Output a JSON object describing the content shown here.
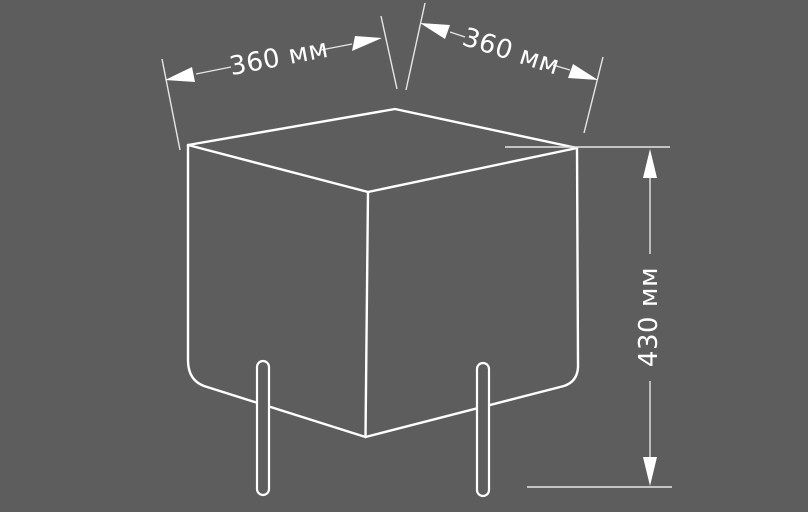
{
  "figure": {
    "type": "technical-dimension-diagram",
    "subject": "cube pouf on cylindrical legs, three-quarter view",
    "colors": {
      "background": "#5d5d5d",
      "outline": "#ffffff",
      "dim_line": "#e6e6e6",
      "arrow": "#ffffff",
      "text": "#ffffff"
    },
    "dimensions": {
      "width": {
        "label": "360 мм"
      },
      "depth": {
        "label": "360 мм"
      },
      "height": {
        "label": "430 мм"
      }
    }
  }
}
